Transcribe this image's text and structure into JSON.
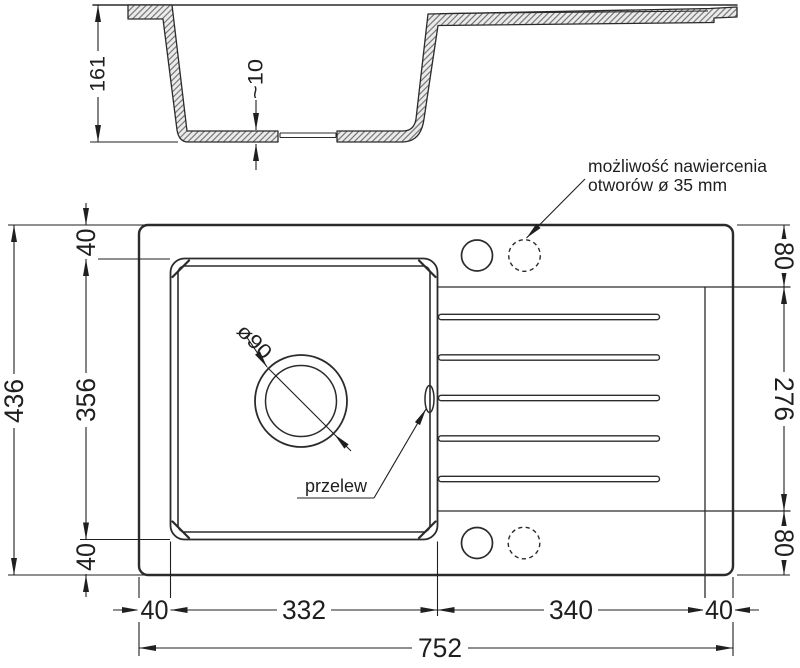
{
  "document": {
    "type": "technical drawing",
    "subject": "kitchen sink with bowl and drainer, section and plan views"
  },
  "colors": {
    "background": "#ffffff",
    "line": "#2b2b2b",
    "dimension": "#1f1f1f",
    "hatch_line": "#5f5f5f",
    "hatch_fill": "#ebebeb"
  },
  "section_view": {
    "height": "161",
    "thickness": "~10"
  },
  "plan_view": {
    "top_offset": "40",
    "bowl_length": "356",
    "bottom_offset": "40",
    "overall_depth": "436",
    "right_top": "80",
    "drainer_length": "276",
    "right_bottom": "80",
    "left_margin": "40",
    "bowl_width": "332",
    "drainer_width": "340",
    "right_margin": "40",
    "overall_width": "752",
    "drain_label": "ø90",
    "overflow_label": "przelew",
    "note_line1": "możliwość nawiercenia",
    "note_line2": "otworów ø 35 mm"
  }
}
